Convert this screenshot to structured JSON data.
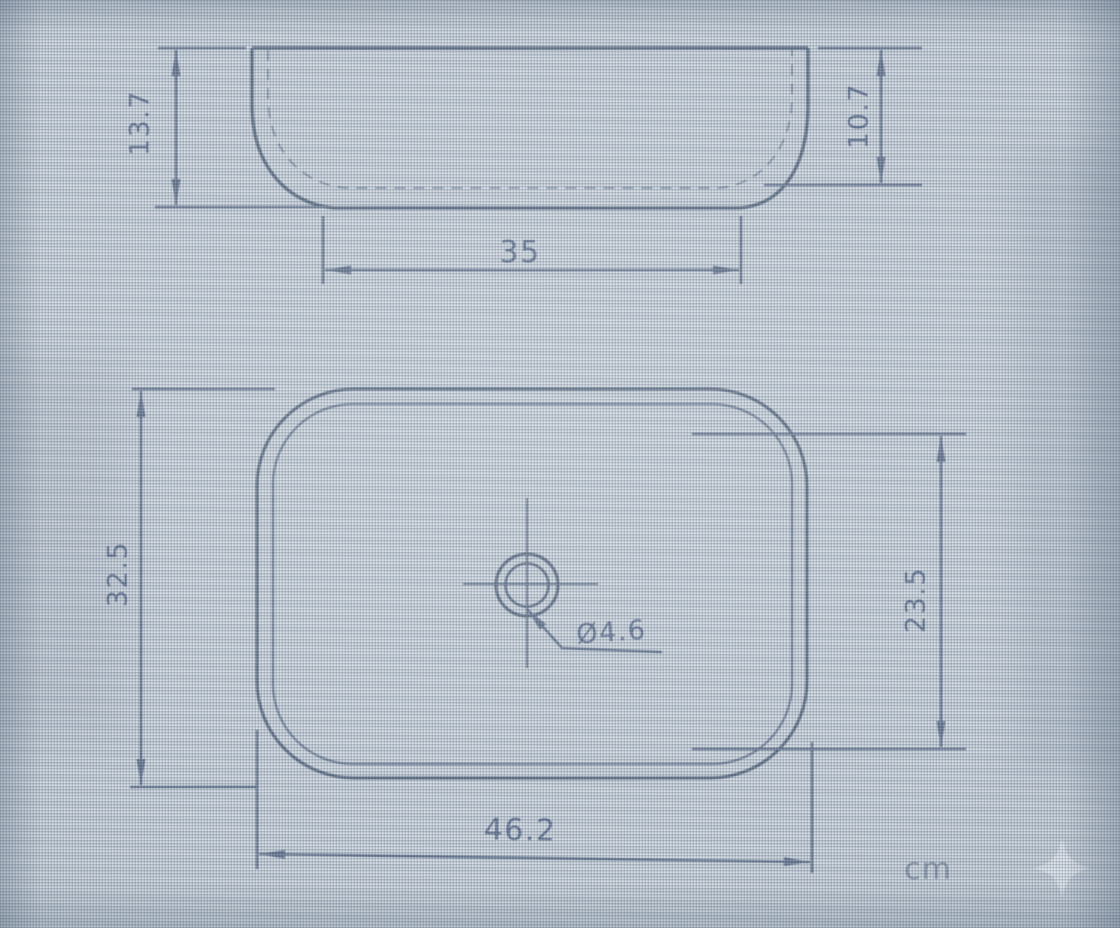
{
  "unit": {
    "label": "cm"
  },
  "dims": {
    "front_overall_height": "13.7",
    "front_inner_depth": "10.7",
    "front_base_width": "35",
    "top_overall_depth": "32.5",
    "top_inner_depth": "23.5",
    "top_overall_length": "46.2",
    "drain_diameter": "Ø4.6"
  },
  "colors": {
    "background": "#c9d2db",
    "object_line": "#44566f",
    "dimension_line": "#4d5f7d",
    "text": "#43567a",
    "sparkle": "#e9eef4"
  },
  "icons": {
    "sparkle": "four-pointed-star watermark"
  }
}
